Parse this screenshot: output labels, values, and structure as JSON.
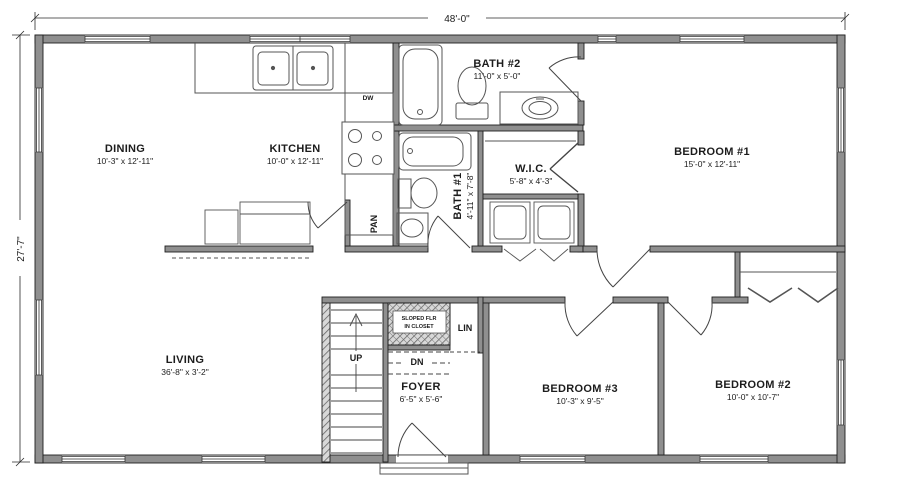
{
  "plan": {
    "overall_width": "48'-0\"",
    "overall_depth": "27'-7\"",
    "rooms": {
      "dining": {
        "name": "DINING",
        "size": "10'-3\" x 12'-11\""
      },
      "kitchen": {
        "name": "KITCHEN",
        "size": "10'-0\" x 12'-11\""
      },
      "bath2": {
        "name": "BATH #2",
        "size": "11'-0\" x 5'-0\""
      },
      "bedroom1": {
        "name": "BEDROOM #1",
        "size": "15'-0\" x 12'-11\""
      },
      "wic": {
        "name": "W.I.C.",
        "size": "5'-8\" x 4'-3\""
      },
      "bath1": {
        "name": "BATH #1",
        "size": "4'-11\" x 7'-8\""
      },
      "living": {
        "name": "LIVING",
        "size": "36'-8\" x 3'-2\""
      },
      "foyer": {
        "name": "FOYER",
        "size": "6'-5\" x 5'-6\""
      },
      "bedroom3": {
        "name": "BEDROOM #3",
        "size": "10'-3\" x 9'-5\""
      },
      "bedroom2": {
        "name": "BEDROOM #2",
        "size": "10'-0\" x 10'-7\""
      }
    },
    "annotations": {
      "pantry": "PAN",
      "linen": "LIN",
      "up": "UP",
      "down": "DN",
      "dishwasher": "DW",
      "sloped_line1": "SLOPED FLR",
      "sloped_line2": "IN CLOSET"
    },
    "colors": {
      "wall_fill": "#8f8f8f",
      "line": "#2a2a2a",
      "background": "#ffffff"
    }
  }
}
